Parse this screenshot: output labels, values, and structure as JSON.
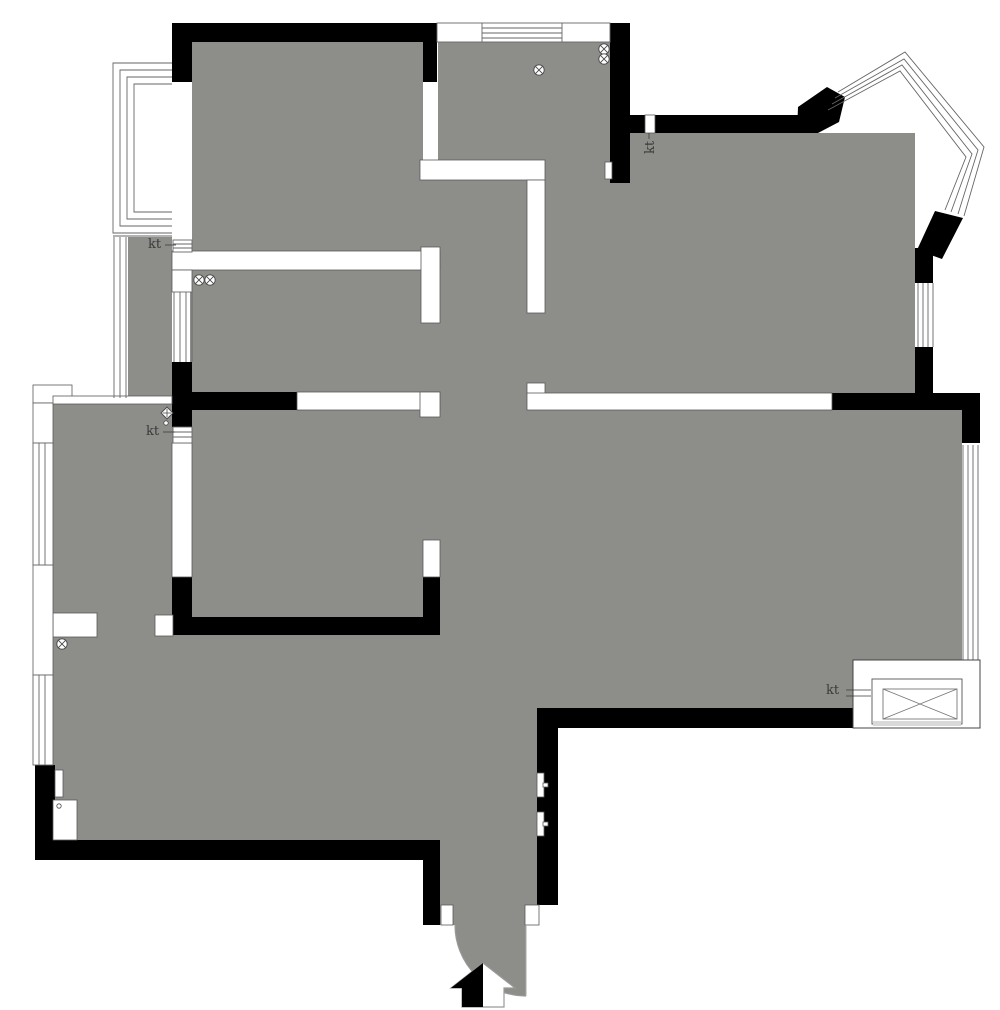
{
  "plan": {
    "labels": {
      "kt_balcony_north": "kt",
      "kt_master_vent": "kt",
      "kt_living_west": "kt",
      "kt_shaft": "kt"
    },
    "colors": {
      "floor": "#8d8d8a",
      "wall": "#000000",
      "partition_outline": "#5a5a5a",
      "window_line": "#666666",
      "label_text": "#3a3a3a",
      "arc_line": "#999999",
      "shaft_strip": "#d9d9d9"
    },
    "symbols": {
      "ceiling_lights": [
        {
          "x": 539,
          "y": 70
        },
        {
          "x": 604,
          "y": 49
        },
        {
          "x": 604,
          "y": 59
        },
        {
          "x": 199,
          "y": 280
        },
        {
          "x": 210,
          "y": 280
        },
        {
          "x": 62,
          "y": 644
        }
      ],
      "diamond_markers": [
        {
          "x": 167,
          "y": 413
        }
      ],
      "small_dots": [
        {
          "x": 166,
          "y": 423
        },
        {
          "x": 59,
          "y": 806
        }
      ]
    }
  }
}
